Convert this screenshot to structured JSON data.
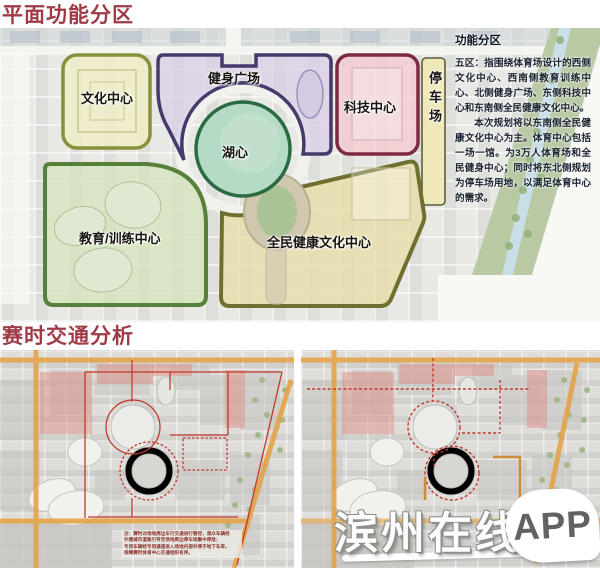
{
  "titles": {
    "zoning": "平面功能分区",
    "traffic": "赛时交通分析"
  },
  "plan": {
    "zones": {
      "culture": {
        "label": "文化中心",
        "fill": "#f0eec5",
        "border": "#8a8f3a"
      },
      "fitness": {
        "label": "健身广场",
        "fill": "#d9cfe6",
        "border": "#46396b"
      },
      "tech": {
        "label": "科技中心",
        "fill": "#f3cad0",
        "border": "#7c2b40"
      },
      "lake": {
        "label": "湖心",
        "fill": "#b5dbc6",
        "border": "#2a6b42"
      },
      "education": {
        "label": "教育/训练中心",
        "fill": "#d4e3bb",
        "border": "#57803c"
      },
      "health": {
        "label": "全民健康文化中心",
        "fill": "#e8dda6",
        "border": "#6f6f2f"
      },
      "parking": {
        "label": "停车场",
        "fill": "#f0e8b4",
        "border": "#5c5c3c"
      }
    },
    "panel": {
      "title": "功能分区",
      "para1": "五区：指围绕体育场设计的西侧文化中心、西南侧教育训练中心、北侧健身广场、东侧科技中心和东南侧全民健康文化中心。",
      "para2": "本次规划将以东南侧全民健康文化中心为主。体育中心包括一场一馆。为3万人体育场和全民健身中心；同时将东北侧规划为停车场用地，以满足体育中心的需求。"
    }
  },
  "traffic": {
    "note": "注：赛时对场地周边车行交通进行管控，观众车辆经\n外围城市道路引导至场地周边停车场集中停放；\n专用车辆经专用通道进入场地内部并停于地下车库，\n保障赛时体育中心交通组织有序。"
  },
  "watermark": {
    "name": "滨州在线",
    "badge": "APP"
  },
  "colors": {
    "title": "#9e3b46",
    "road_orange": "#e5a245",
    "route_red": "#bf3a2c"
  }
}
